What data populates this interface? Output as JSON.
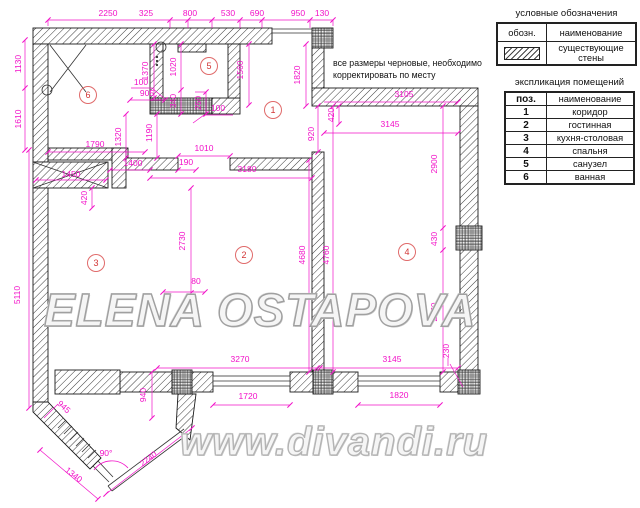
{
  "note": {
    "line1": "все размеры черновые, необходимо",
    "line2": "корректировать по месту"
  },
  "legend": {
    "title": "условные обозначения",
    "col_symbol": "обозн.",
    "col_name": "наименование",
    "rows": [
      {
        "symbol": "existing-walls-hatch",
        "label": "существующие стены"
      }
    ]
  },
  "schedule": {
    "title": "экспликация помещений",
    "col_pos": "поз.",
    "col_name": "наименование",
    "rows": [
      {
        "num": "1",
        "name": "коридор"
      },
      {
        "num": "2",
        "name": "гостинная"
      },
      {
        "num": "3",
        "name": "кухня-столовая"
      },
      {
        "num": "4",
        "name": "спальня"
      },
      {
        "num": "5",
        "name": "санузел"
      },
      {
        "num": "6",
        "name": "ванная"
      }
    ]
  },
  "watermarks": {
    "primary": "ELENA OSTAPOVA",
    "secondary": "www.divandi.ru"
  },
  "room_markers": [
    "1",
    "2",
    "3",
    "4",
    "5",
    "6"
  ],
  "dims": {
    "top": [
      "2250",
      "325",
      "800",
      "530",
      "690",
      "950",
      "130"
    ],
    "left": [
      "1130",
      "1610",
      "5110"
    ],
    "bath": [
      "1790",
      "1320",
      "1190",
      "1400",
      "1450",
      "420"
    ],
    "wc": [
      "1370",
      "1020",
      "340",
      "250",
      "905",
      "100",
      "100"
    ],
    "hall": [
      "1560",
      "1820",
      "920",
      "420",
      "1010",
      "190"
    ],
    "living": [
      "3180",
      "2730",
      "80",
      "4680",
      "4760"
    ],
    "bed": [
      "3105",
      "3145",
      "2900",
      "430",
      "2870",
      "230",
      "3145",
      "1820"
    ],
    "bottom": [
      "3270",
      "1720",
      "940"
    ],
    "bay": [
      "945",
      "90°",
      "1340",
      "2240"
    ]
  },
  "colors": {
    "dimension": "#f210c8",
    "walls": "#1a1a1a",
    "marker": "#d94f4f",
    "watermark": "#a0a0a0"
  }
}
